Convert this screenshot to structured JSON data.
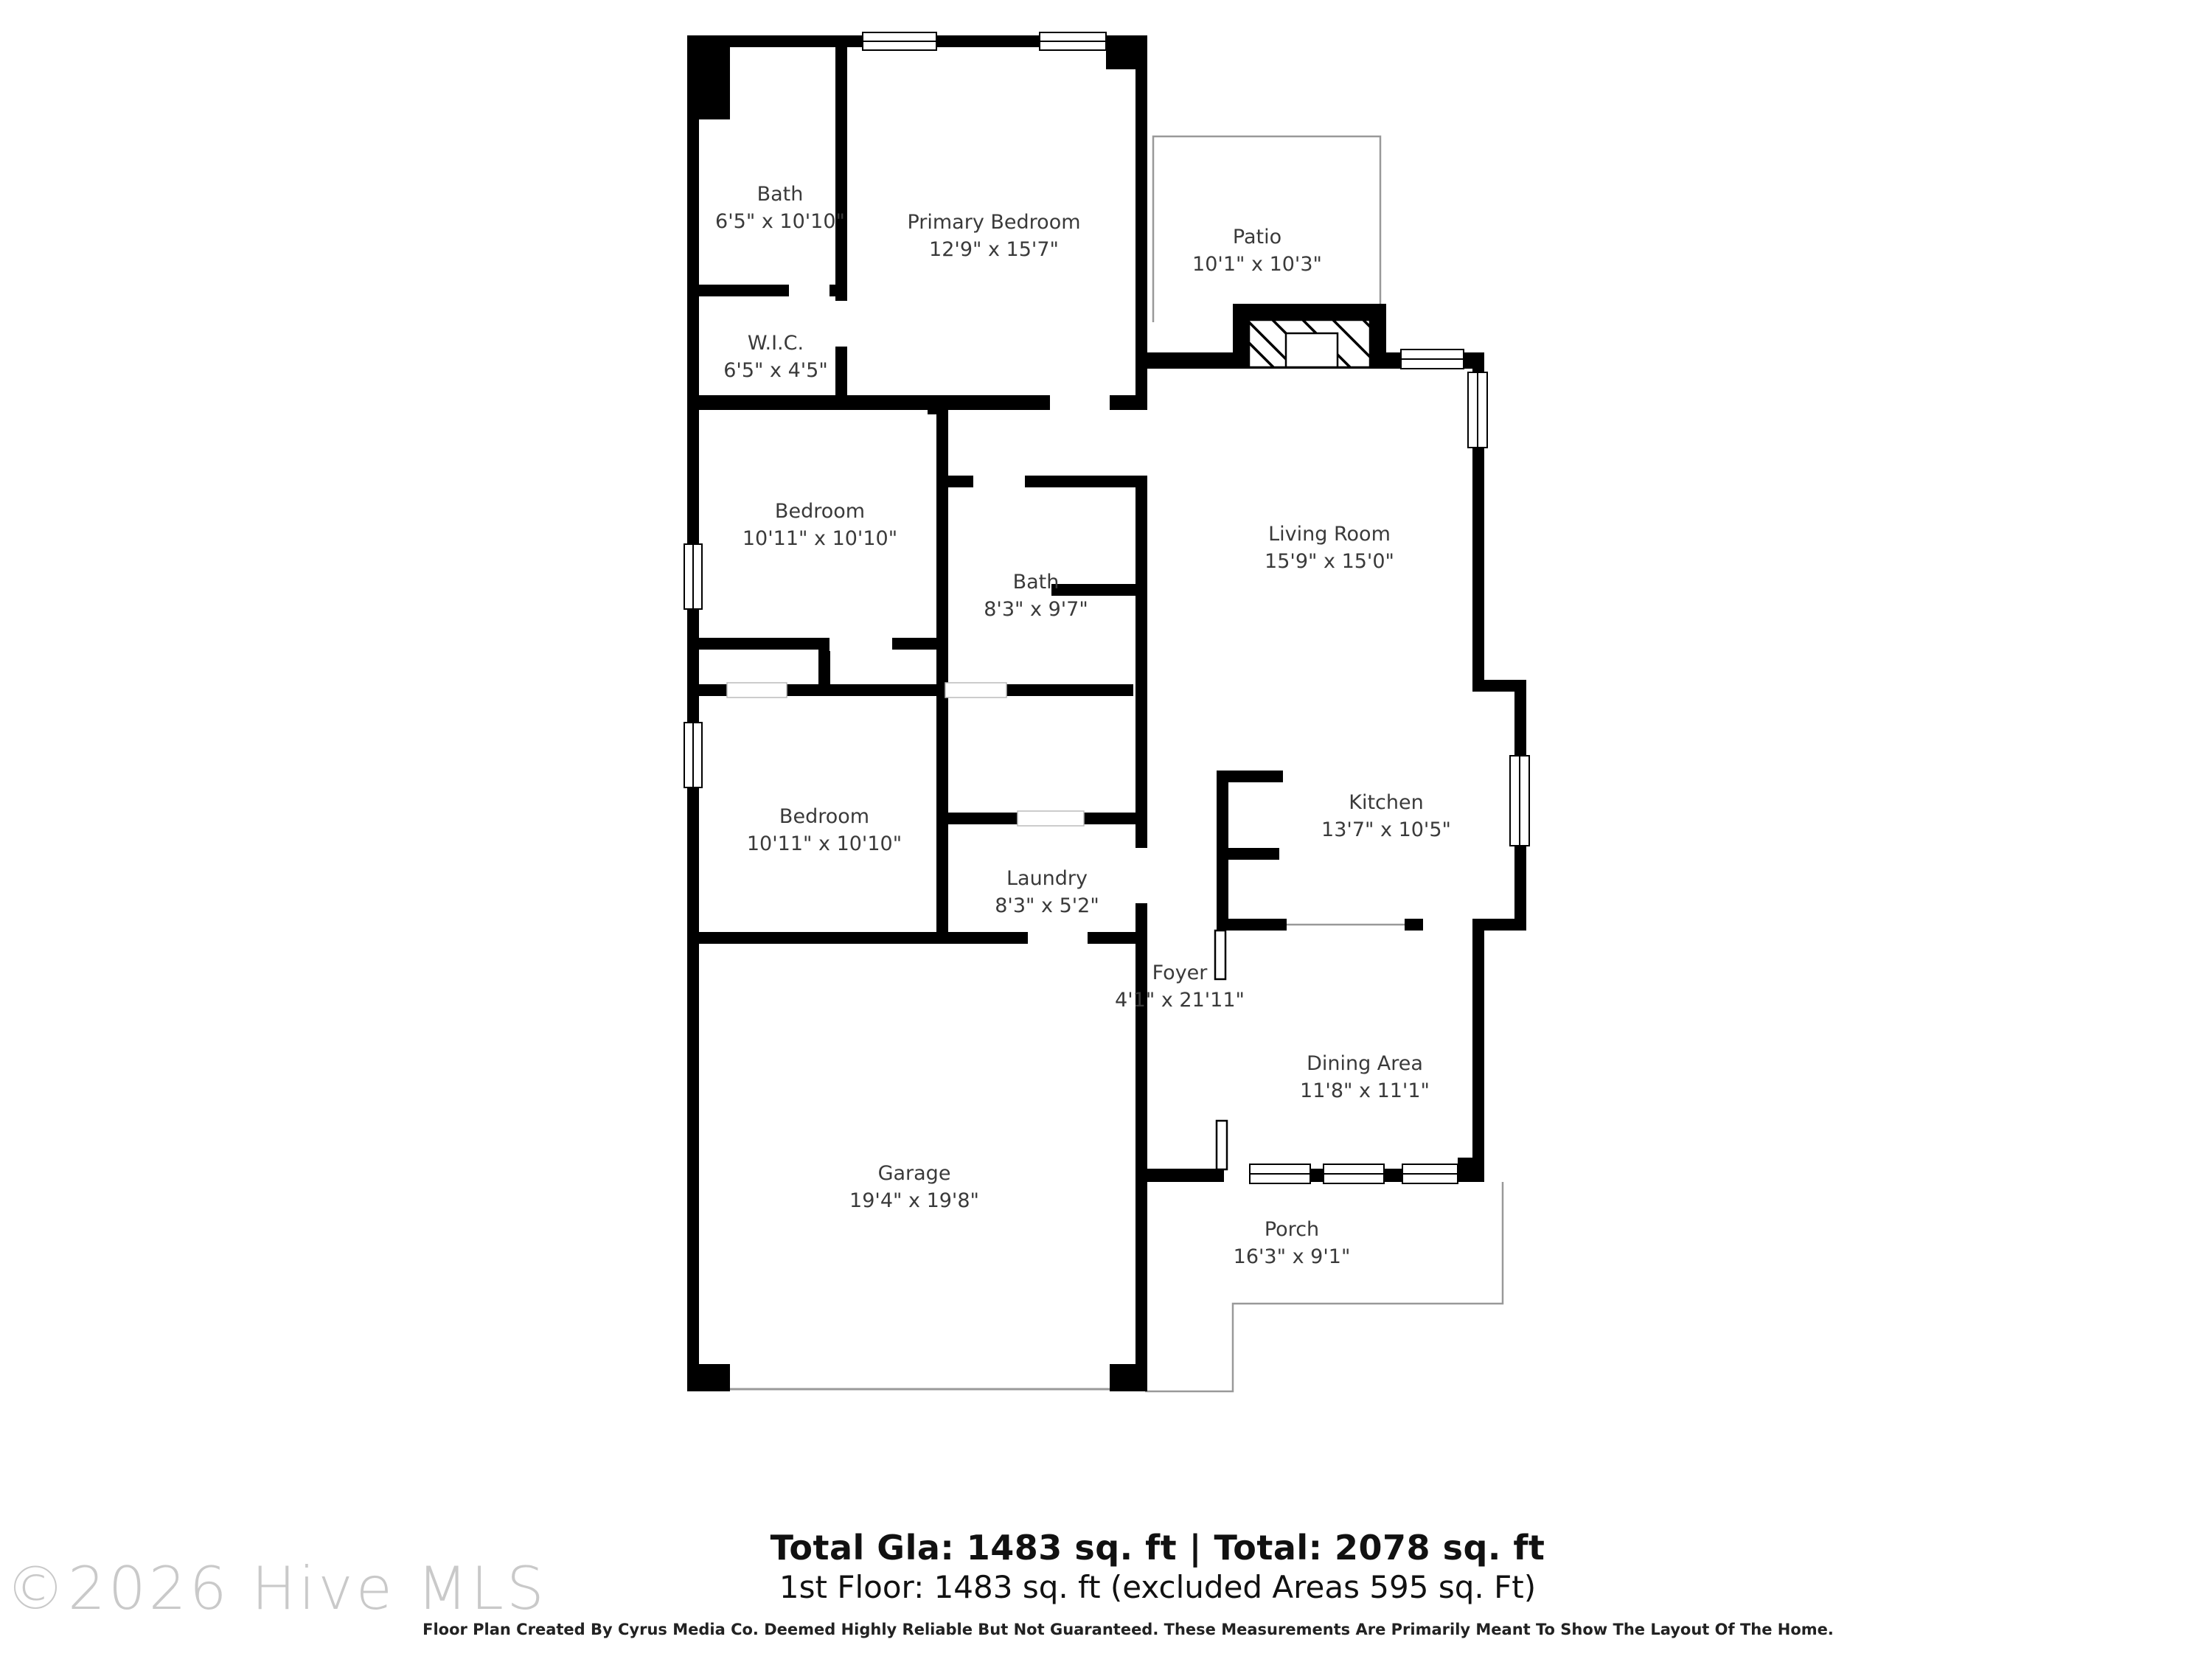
{
  "rooms": [
    {
      "name": "Bath",
      "dims": "6'5\" x 10'10\""
    },
    {
      "name": "Primary Bedroom",
      "dims": "12'9\" x 15'7\""
    },
    {
      "name": "Patio",
      "dims": "10'1\" x 10'3\""
    },
    {
      "name": "W.I.C.",
      "dims": "6'5\" x 4'5\""
    },
    {
      "name": "Bedroom",
      "dims": "10'11\" x 10'10\""
    },
    {
      "name": "Bath",
      "dims": "8'3\" x 9'7\""
    },
    {
      "name": "Living Room",
      "dims": "15'9\" x 15'0\""
    },
    {
      "name": "Kitchen",
      "dims": "13'7\" x 10'5\""
    },
    {
      "name": "Bedroom",
      "dims": "10'11\" x 10'10\""
    },
    {
      "name": "Laundry",
      "dims": "8'3\" x 5'2\""
    },
    {
      "name": "Foyer",
      "dims": "4'1\" x 21'11\""
    },
    {
      "name": "Dining Area",
      "dims": "11'8\" x 11'1\""
    },
    {
      "name": "Garage",
      "dims": "19'4\" x 19'8\""
    },
    {
      "name": "Porch",
      "dims": "16'3\" x 9'1\""
    }
  ],
  "footer": {
    "totals_bold": "Total Gla: 1483 sq. ft | Total: 2078 sq. ft",
    "floor_line": "1st Floor: 1483 sq. ft (excluded Areas 595 sq. Ft)",
    "disclaimer": "Floor Plan Created By Cyrus Media Co. Deemed Highly Reliable But Not Guaranteed. These Measurements Are Primarily Meant To Show The Layout Of The Home."
  },
  "watermark": "©2026 Hive MLS",
  "colors": {
    "wall": "#000000",
    "thin_line": "#999999",
    "label_text": "#3a3a3a",
    "watermark": "#c9c9c9"
  }
}
